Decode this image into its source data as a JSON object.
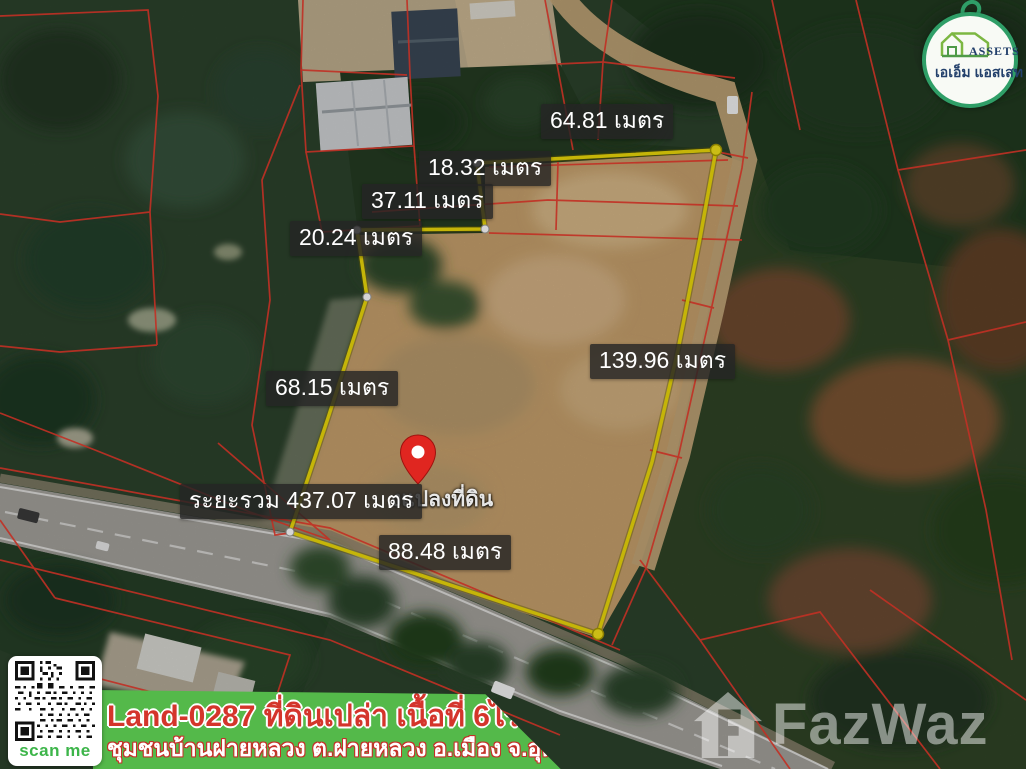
{
  "logo": {
    "name_en": "ASSETS",
    "name_th": "เอเอ็ม แอสเสท"
  },
  "measurements": {
    "top_edge": "64.81 เมตร",
    "edge_18": "18.32 เมตร",
    "edge_37": "37.11 เมตร",
    "edge_20": "20.24 เมตร",
    "right_edge": "139.96 เมตร",
    "left_edge": "68.15 เมตร",
    "total": "ระยะรวม 437.07 เมตร",
    "bottom_edge": "88.48 เมตร"
  },
  "pin": {
    "caption_visible": "งแปลงที่ดิน"
  },
  "qr": {
    "label": "scan me"
  },
  "banner": {
    "line1": "Land-0287 ที่ดินเปล่า เนื้อที่ 6ไร่ 94.6ตร.ว.",
    "line2": "ชุมชนบ้านฝายหลวง ต.ฝายหลวง อ.เมือง จ.อุตรดิตถ์"
  },
  "watermark": {
    "brand": "FazWaz"
  },
  "accent_colors": {
    "plot_outline_yellow": "#ecd90a",
    "parcel_line_red": "#e83a2c",
    "banner_green": "#54b94a",
    "banner_red": "#d4352b",
    "logo_ring_green": "#2f9e67",
    "scan_me_green": "#3db54a",
    "pin_red": "#e02620"
  }
}
